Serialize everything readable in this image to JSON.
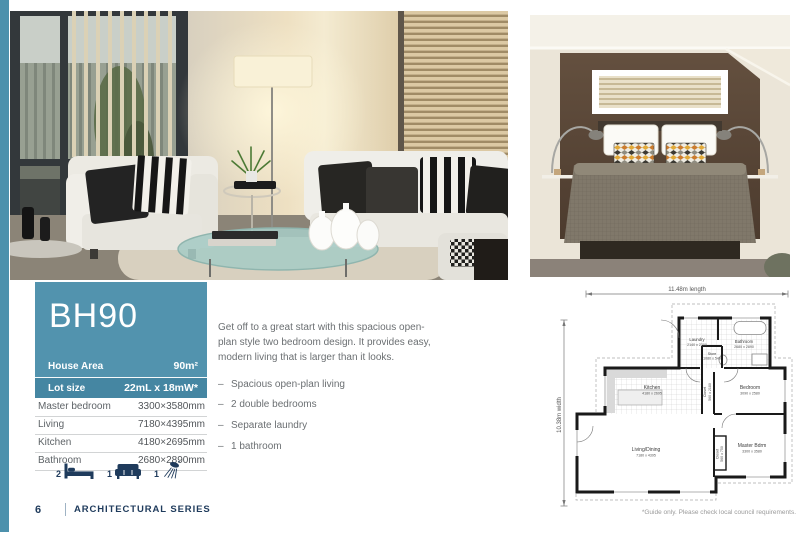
{
  "page": {
    "number": "6",
    "series": "ARCHITECTURAL SERIES"
  },
  "model": {
    "name": "BH90",
    "house_area_label": "House Area",
    "house_area_value": "90m²",
    "lot_size_label": "Lot size",
    "lot_size_value": "22mL x 18mW*"
  },
  "specs": {
    "rows": [
      {
        "label": "Master bedroom",
        "value": "3300×3580mm"
      },
      {
        "label": "Living",
        "value": "7180×4395mm"
      },
      {
        "label": "Kitchen",
        "value": "4180×2695mm"
      },
      {
        "label": "Bathroom",
        "value": "2680×2890mm"
      }
    ]
  },
  "features": {
    "items": [
      {
        "icon": "bed-icon",
        "count": "2"
      },
      {
        "icon": "sofa-icon",
        "count": "1"
      },
      {
        "icon": "shower-icon",
        "count": "1"
      }
    ]
  },
  "description": {
    "paragraph": "Get off to a great start with this spacious open-plan style two bedroom design. It provides easy, modern living that is larger than it looks.",
    "bullets": [
      "Spacious open-plan living",
      "2 double bedrooms",
      "Separate laundry",
      "1 bathroom"
    ]
  },
  "floorplan": {
    "length_label": "11.48m length",
    "width_label": "10.38m width",
    "note": "*Guide only. Please check local council requirements.",
    "rooms": [
      {
        "name": "Laundry",
        "dims": "2140 x 2200"
      },
      {
        "name": "Bathroom",
        "dims": "2680 x 2890"
      },
      {
        "name": "Store",
        "dims": "1080 x 540"
      },
      {
        "name": "Kitchen",
        "dims": "4180 x 2695"
      },
      {
        "name": "Closet",
        "dims": "560 x 2180"
      },
      {
        "name": "Bedroom",
        "dims": "3090 x 2580"
      },
      {
        "name": "Living/Dining",
        "dims": "7180 x 4395"
      },
      {
        "name": "Closet",
        "dims": "560 x 750"
      },
      {
        "name": "Master Bdrm",
        "dims": "3300 x 3580"
      }
    ]
  },
  "colors": {
    "accent": "#5293AE",
    "accent_dark": "#4586A2",
    "accent_strip": "#4D91AC",
    "navy": "#1F3B5C"
  }
}
